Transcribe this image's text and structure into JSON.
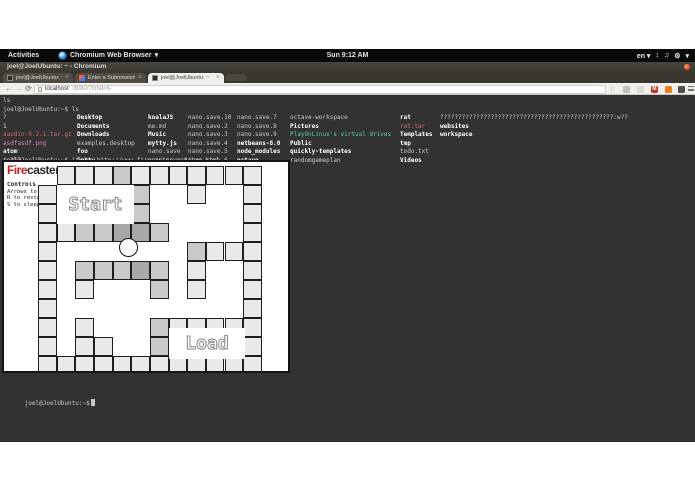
{
  "gnome_bar": {
    "activities": "Activities",
    "app_name": "Chromium Web Browser",
    "app_caret": "▾",
    "clock": "Sun 9:12 AM",
    "lang": "en ▾",
    "tray_icons": [
      "↕",
      "♫",
      "⚙",
      "▾"
    ]
  },
  "window": {
    "title": "joel@JoelUbuntu: ~ - Chromium"
  },
  "tabs": [
    {
      "title": "joel@JoelUbuntu: ~/",
      "close": "×",
      "favicon": "terminal-favicon"
    },
    {
      "title": "Enter a Submission | D",
      "close": "×",
      "favicon": "devpost-favicon"
    },
    {
      "title": "joel@JoelUbuntu: ~",
      "close": "×",
      "favicon": "terminal-favicon",
      "active": true
    }
  ],
  "toolbar": {
    "back": "←",
    "forward": "→",
    "reload": "⟳",
    "url_host": "localhost",
    "url_rest": ":8080/?cmd=ls",
    "star": "☆",
    "mail_glyph": "M",
    "icons": [
      "bookmark-star",
      "window-extension",
      "ghost-extension",
      "mail-extension",
      "rss-extension",
      "dark-extension",
      "menu"
    ]
  },
  "terminal": {
    "line_ls_echo": "ls",
    "prompt_ls": "joel@JoelUbuntu:~$ ls",
    "prompt_iframe": "joel@JoelUbuntu:~$ iframe http://www.firecaster.com/tay.html",
    "prompt_final": "joel@JoelUbuntu:~$",
    "colors": {
      "p": "#c9c9c9",
      "d": "#ffffff",
      "a": "#cd6a6a",
      "i": "#d58ab4",
      "l": "#63c5b5"
    },
    "ls_columns": [
      {
        "x": 3,
        "items": [
          {
            "t": "?",
            "s": "p"
          },
          {
            "t": "1",
            "s": "p"
          },
          {
            "t": "aaudio-0.2.1.tar.gz",
            "s": "a"
          },
          {
            "t": "asdfasdf.png",
            "s": "i"
          },
          {
            "t": "atom",
            "s": "d"
          },
          {
            "t": "cs357",
            "s": "p"
          }
        ]
      },
      {
        "x": 77,
        "items": [
          {
            "t": "Desktop",
            "s": "d"
          },
          {
            "t": "Documents",
            "s": "d"
          },
          {
            "t": "Downloads",
            "s": "d"
          },
          {
            "t": "examples.desktop",
            "s": "p"
          },
          {
            "t": "foo",
            "s": "d"
          },
          {
            "t": "jotty",
            "s": "d"
          }
        ]
      },
      {
        "x": 148,
        "items": [
          {
            "t": "koalaJS",
            "s": "d"
          },
          {
            "t": "me.md",
            "s": "p"
          },
          {
            "t": "Music",
            "s": "d"
          },
          {
            "t": "mytty.js",
            "s": "d"
          },
          {
            "t": "nano.save",
            "s": "p"
          },
          {
            "t": "nano.save.1",
            "s": "p"
          }
        ]
      },
      {
        "x": 188,
        "items": [
          {
            "t": "nano.save.10",
            "s": "p"
          },
          {
            "t": "nano.save.2",
            "s": "p"
          },
          {
            "t": "nano.save.3",
            "s": "p"
          },
          {
            "t": "nano.save.4",
            "s": "p"
          },
          {
            "t": "nano.save.5",
            "s": "p"
          },
          {
            "t": "nano.save.6",
            "s": "p"
          }
        ]
      },
      {
        "x": 237,
        "items": [
          {
            "t": "nano.save.7",
            "s": "p"
          },
          {
            "t": "nano.save.8",
            "s": "p"
          },
          {
            "t": "nano.save.9",
            "s": "p"
          },
          {
            "t": "netbeans-8.0",
            "s": "d"
          },
          {
            "t": "node_modules",
            "s": "d"
          },
          {
            "t": "octave",
            "s": "d"
          }
        ]
      },
      {
        "x": 290,
        "items": [
          {
            "t": "octave-workspace",
            "s": "p"
          },
          {
            "t": "Pictures",
            "s": "d"
          },
          {
            "t": "PlayOnLinux's virtual drives",
            "s": "l"
          },
          {
            "t": "Public",
            "s": "d"
          },
          {
            "t": "quickly-templates",
            "s": "d"
          },
          {
            "t": "randomgameplan",
            "s": "p"
          }
        ]
      },
      {
        "x": 400,
        "items": [
          {
            "t": "rat",
            "s": "d"
          },
          {
            "t": "rat.tar",
            "s": "a"
          },
          {
            "t": "Templates",
            "s": "d"
          },
          {
            "t": "tmp",
            "s": "d"
          },
          {
            "t": "todo.txt",
            "s": "p"
          },
          {
            "t": "Videos",
            "s": "d"
          }
        ]
      },
      {
        "x": 440,
        "items": [
          {
            "t": "????????????????????????????????????????????????:w??",
            "s": "p"
          },
          {
            "t": "websites",
            "s": "d"
          },
          {
            "t": "workspace",
            "s": "d"
          }
        ]
      }
    ]
  },
  "game": {
    "logo_fire": "Fire",
    "logo_caster": "caster",
    "controls_title": "Controls",
    "controls": [
      "Arrows to move",
      "R to restart",
      "S to sleep"
    ],
    "start_label": "Start",
    "load_label": "Load",
    "cell_colors": {
      "L": "#e9e9e9",
      "M": "#c9c9c9",
      "D": "#a8a8a8"
    },
    "grid_rows": [
      ".LLLMLLLLLLL",
      "L....M..L..L",
      "L....M.....L",
      "LLMMDDM....L",
      "L.......MLLL",
      "L.MMMDM.L..L",
      "L.L...M.L..L",
      "L..........L",
      "L.L...MLLLLL",
      "L.LL..M....L",
      "LLLLLLLLLLLL"
    ]
  }
}
